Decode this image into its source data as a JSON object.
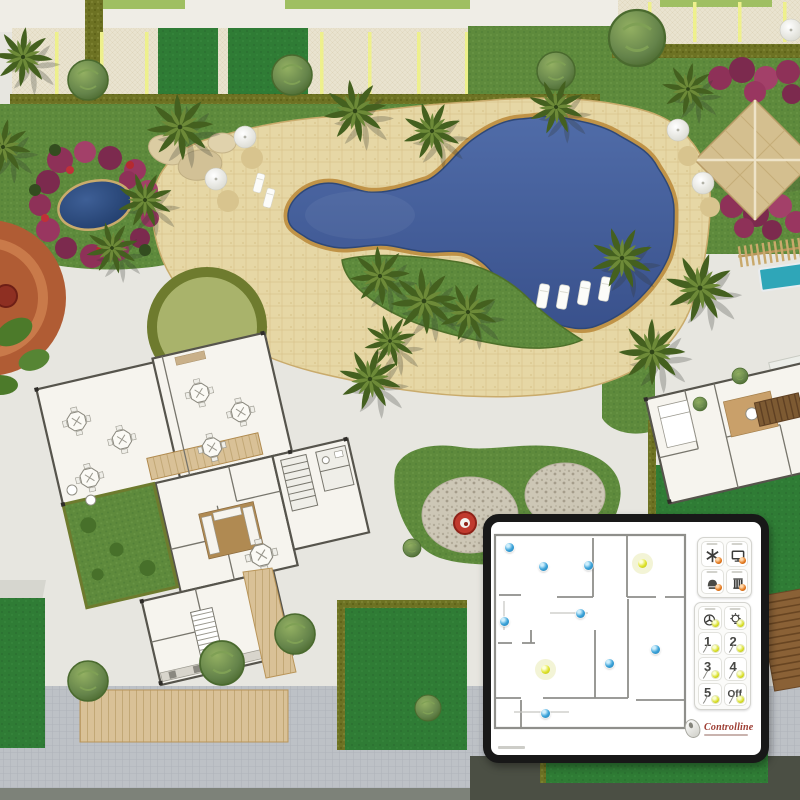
{
  "colors": {
    "pool_water": "#44619e",
    "pool_coping": "#c69a4c",
    "deck_sand": "#e6d8a6",
    "lawn": "#5e8a3c",
    "lawn_dark": "#2f7c35",
    "hedge_olive": "#6d7223",
    "parking_pavement": "#e9e3cf",
    "parking_stripe": "#eef08c",
    "paver_gray": "#bcc0c5",
    "flower_magenta": "#993660",
    "court_terracotta": "#b05c34",
    "panel_border": "#181818",
    "sensor_blue": "#3da4da",
    "light_yellow": "#dfe32c",
    "indicator_orange": "#e2761a",
    "logo_red": "#9c3b31"
  },
  "overlay_panel": {
    "floorplan": {
      "dots": [
        {
          "x": 18,
          "y": 25,
          "kind": "sensor"
        },
        {
          "x": 52,
          "y": 44,
          "kind": "sensor"
        },
        {
          "x": 97,
          "y": 43,
          "kind": "sensor"
        },
        {
          "x": 151,
          "y": 41,
          "kind": "light"
        },
        {
          "x": 13,
          "y": 99,
          "kind": "sensor"
        },
        {
          "x": 89,
          "y": 91,
          "kind": "sensor"
        },
        {
          "x": 54,
          "y": 147,
          "kind": "light"
        },
        {
          "x": 118,
          "y": 141,
          "kind": "sensor"
        },
        {
          "x": 164,
          "y": 127,
          "kind": "sensor"
        },
        {
          "x": 54,
          "y": 191,
          "kind": "sensor"
        }
      ]
    },
    "device_buttons": [
      {
        "icon": "snowflake-ac-icon"
      },
      {
        "icon": "tv-icon"
      },
      {
        "icon": "hood-lamp-icon"
      },
      {
        "icon": "blinds-icon"
      }
    ],
    "scene_buttons": [
      {
        "icon": "fan-icon",
        "label": ""
      },
      {
        "icon": "bulb-icon",
        "label": ""
      },
      {
        "label": "1"
      },
      {
        "label": "2"
      },
      {
        "label": "3"
      },
      {
        "label": "4"
      },
      {
        "label": "5"
      },
      {
        "label": "Off"
      }
    ],
    "logo_text": "Controlline"
  }
}
